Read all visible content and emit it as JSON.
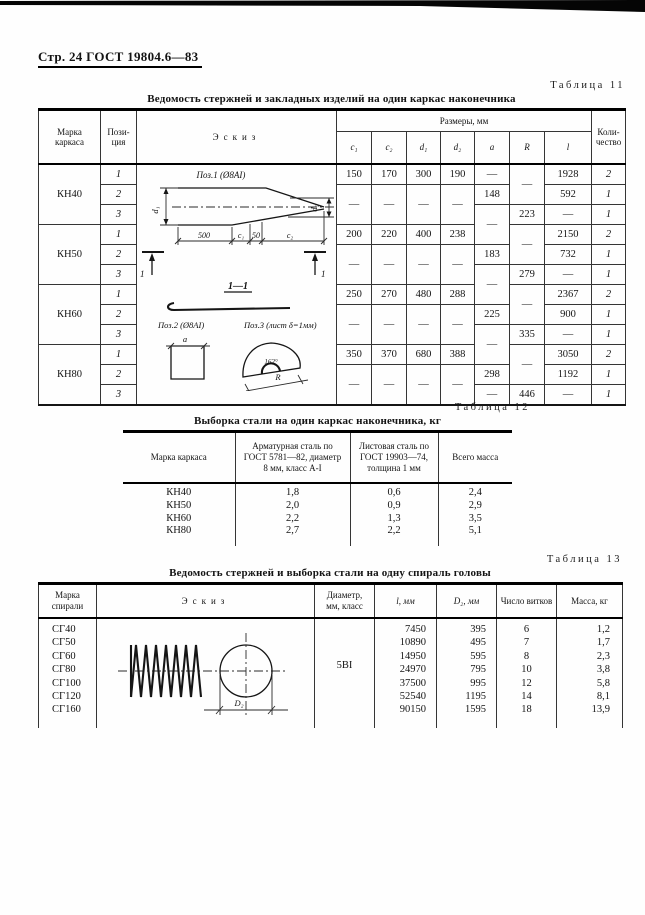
{
  "page": {
    "header_prefix": "Стр. 24",
    "header_gost": "ГОСТ 19804.6—83"
  },
  "table11": {
    "label": "Таблица 11",
    "title": "Ведомость стержней и закладных изделий на один каркас наконечника",
    "head": {
      "marka": "Марка\nкаркаса",
      "pos": "Пози-\nция",
      "eskiz": "Эскиз",
      "group": "Размеры, мм",
      "c1": "c₁",
      "c2": "c₂",
      "d1": "d₁",
      "d2": "d₂",
      "a": "a",
      "R": "R",
      "l": "l",
      "qty": "Коли-\nчество"
    },
    "marki": [
      "КН40",
      "КН50",
      "КН60",
      "КН80"
    ],
    "rows": [
      {
        "pos": "1",
        "c1": "150",
        "c2": "170",
        "d1": "300",
        "d2": "190",
        "a": "—",
        "R": "—",
        "l": "1928",
        "qty": "2"
      },
      {
        "pos": "2",
        "c1": "—",
        "c2": "—",
        "d1": "—",
        "d2": "—",
        "a": "148",
        "l": "592",
        "qty": "1"
      },
      {
        "pos": "3",
        "a": "—",
        "R": "223",
        "l": "—",
        "qty": "1"
      },
      {
        "pos": "1",
        "c1": "200",
        "c2": "220",
        "d1": "400",
        "d2": "238",
        "R": "—",
        "l": "2150",
        "qty": "2"
      },
      {
        "pos": "2",
        "c1": "—",
        "c2": "—",
        "d1": "—",
        "d2": "—",
        "a": "183",
        "l": "732",
        "qty": "1"
      },
      {
        "pos": "3",
        "a": "—",
        "R": "279",
        "l": "—",
        "qty": "1"
      },
      {
        "pos": "1",
        "c1": "250",
        "c2": "270",
        "d1": "480",
        "d2": "288",
        "R": "—",
        "l": "2367",
        "qty": "2"
      },
      {
        "pos": "2",
        "c1": "—",
        "c2": "—",
        "d1": "—",
        "d2": "—",
        "a": "225",
        "l": "900",
        "qty": "1"
      },
      {
        "pos": "3",
        "a": "—",
        "R": "335",
        "l": "—",
        "qty": "1"
      },
      {
        "pos": "1",
        "c1": "350",
        "c2": "370",
        "d1": "680",
        "d2": "388",
        "R": "—",
        "l": "3050",
        "qty": "2"
      },
      {
        "pos": "2",
        "c1": "—",
        "c2": "—",
        "d1": "—",
        "d2": "—",
        "a": "298",
        "l": "1192",
        "qty": "1"
      },
      {
        "pos": "3",
        "a": "—",
        "R": "446",
        "l": "—",
        "qty": "1"
      }
    ],
    "sketch": {
      "pos1": "Поз.1 (Ø8АI)",
      "d1": "d₁",
      "d2": "d₂",
      "dim500": "500",
      "c1": "c₁",
      "dim50": "50",
      "c2": "c₂",
      "sec": "1",
      "section": "1—1",
      "pos2": "Поз.2 (Ø8АI)",
      "a": "a",
      "pos3": "Поз.3 (лист δ=1мм)",
      "angle": "162°",
      "R": "R"
    }
  },
  "table12": {
    "label": "Таблица 12",
    "title": "Выборка стали на один каркас наконечника, кг",
    "head": {
      "marka": "Марка каркаса",
      "arm": "Арматурная сталь по\nГОСТ 5781—82, диаметр\n8 мм, класс А-I",
      "list": "Листовая сталь по\nГОСТ 19903—74,\nтолщина 1 мм",
      "total": "Всего масса"
    },
    "rows": [
      {
        "marka": "КН40",
        "arm": "1,8",
        "list": "0,6",
        "total": "2,4"
      },
      {
        "marka": "КН50",
        "arm": "2,0",
        "list": "0,9",
        "total": "2,9"
      },
      {
        "marka": "КН60",
        "arm": "2,2",
        "list": "1,3",
        "total": "3,5"
      },
      {
        "marka": "КН80",
        "arm": "2,7",
        "list": "2,2",
        "total": "5,1"
      }
    ]
  },
  "table13": {
    "label": "Таблица 13",
    "title": "Ведомость стержней и выборка стали на одну спираль головы",
    "head": {
      "marka": "Марка\nспирали",
      "eskiz": "Эскиз",
      "diam": "Диаметр,\nмм, класс",
      "l": "l, мм",
      "d2": "D₂, мм",
      "vitki": "Число витков",
      "massa": "Масса, кг"
    },
    "diam_value": "5ВI",
    "rows": [
      {
        "marka": "СГ40",
        "l": "7450",
        "d2": "395",
        "vitki": "6",
        "massa": "1,2"
      },
      {
        "marka": "СГ50",
        "l": "10890",
        "d2": "495",
        "vitki": "7",
        "massa": "1,7"
      },
      {
        "marka": "СГ60",
        "l": "14950",
        "d2": "595",
        "vitki": "8",
        "massa": "2,3"
      },
      {
        "marka": "СГ80",
        "l": "24970",
        "d2": "795",
        "vitki": "10",
        "massa": "3,8"
      },
      {
        "marka": "СГ100",
        "l": "37500",
        "d2": "995",
        "vitki": "12",
        "massa": "5,8"
      },
      {
        "marka": "СГ120",
        "l": "52540",
        "d2": "1195",
        "vitki": "14",
        "massa": "8,1"
      },
      {
        "marka": "СГ160",
        "l": "90150",
        "d2": "1595",
        "vitki": "18",
        "massa": "13,9"
      }
    ],
    "sketch": {
      "D2": "D₂"
    }
  }
}
